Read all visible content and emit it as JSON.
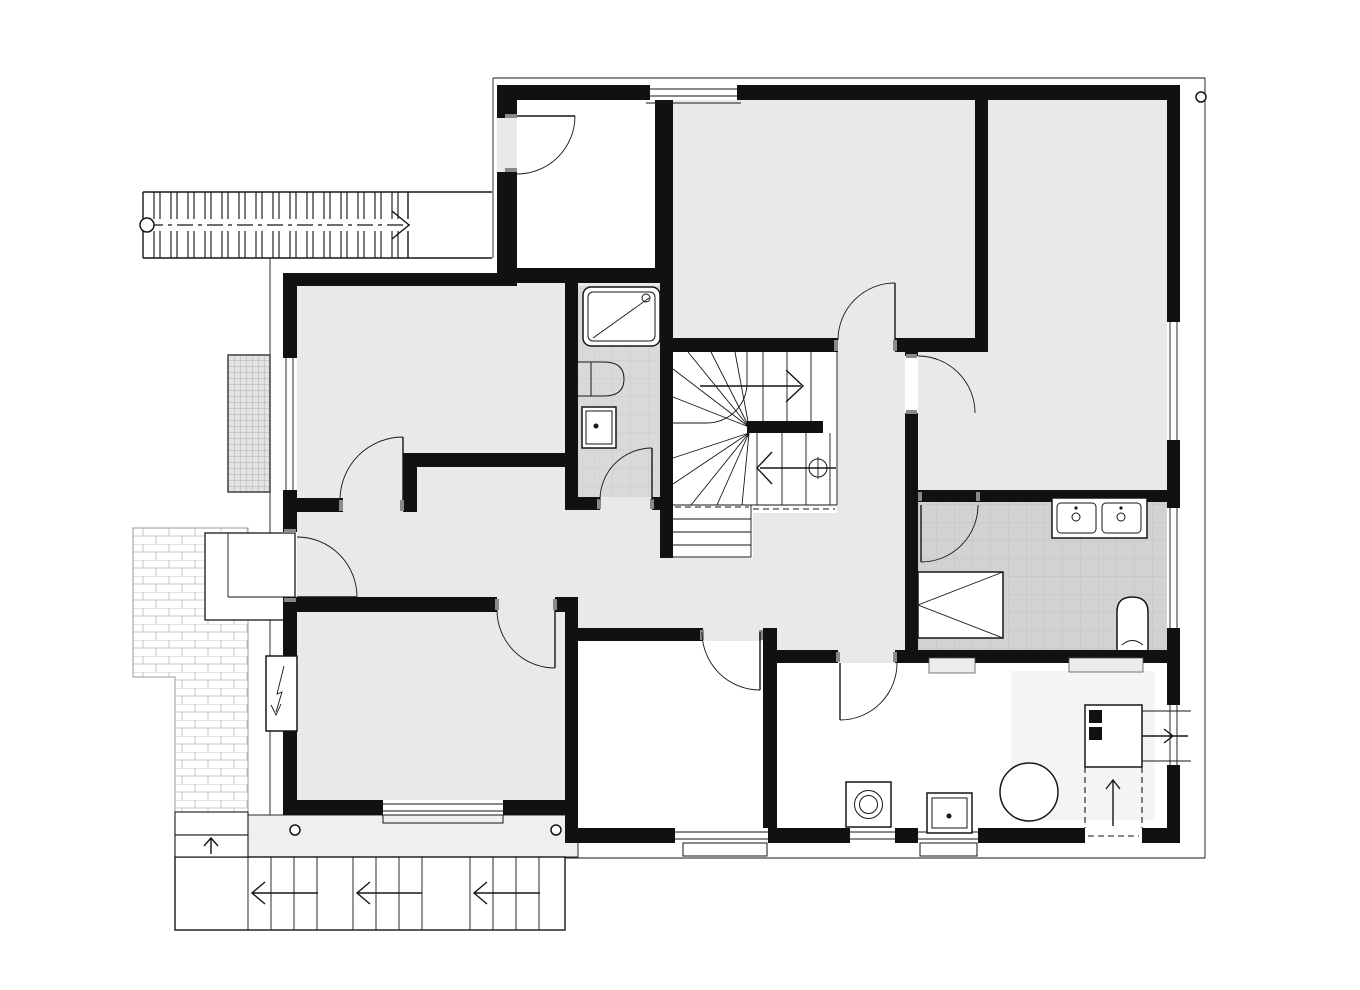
{
  "document": {
    "type": "architectural-floor-plan",
    "level": "basement-storey",
    "style": "black-and-white CAD line drawing, no text labels",
    "canvas_px": {
      "width": 1360,
      "height": 990
    }
  },
  "colors": {
    "background": "#ffffff",
    "wall": "#111111",
    "room_gray": "#e9e9e9",
    "bath_tile": "#d9d9d9",
    "kitchen_tile": "#d2d2d2",
    "terrace": "#efefef",
    "platform": "#f4f4f4",
    "niche": "#ececec",
    "drawing_line": "#161616",
    "brick_line": "#c8c8c8",
    "lightwell_fill": "#e3e3e3",
    "lightwell_line": "#9d9d9d"
  },
  "rooms": [
    {
      "name": "entry-vestibule-room",
      "floor": "white",
      "position": "top-left inside plan"
    },
    {
      "name": "top-center-room",
      "floor": "gray",
      "position": "top-center"
    },
    {
      "name": "top-right-room",
      "floor": "gray",
      "position": "top-right, L-shaped"
    },
    {
      "name": "left-upper-room",
      "floor": "gray",
      "position": "left"
    },
    {
      "name": "left-lower-room",
      "floor": "gray",
      "position": "bottom-left"
    },
    {
      "name": "hallway",
      "floor": "gray",
      "position": "central connecting corridor"
    },
    {
      "name": "bathroom",
      "floor": "tiled",
      "position": "center-left, shower + wc + basin"
    },
    {
      "name": "stairwell",
      "floor": "white",
      "position": "center winder stair"
    },
    {
      "name": "bottom-middle-room",
      "floor": "white",
      "position": "bottom-center"
    },
    {
      "name": "kitchen-laundry-room",
      "floor": "tiled",
      "position": "right, double sink"
    },
    {
      "name": "boiler-room",
      "floor": "white",
      "position": "bottom-right, appliances"
    }
  ],
  "fixtures": [
    "shower-tray",
    "toilet",
    "washbasin",
    "double-sink",
    "fold-down-table",
    "small-basin",
    "washing-machine",
    "laundry-tub",
    "boiler-tank",
    "heating-unit",
    "flue-shaft",
    "electric-meter-box"
  ],
  "stairs": {
    "exterior_top_stair": {
      "treads": 16,
      "direction_arrow": "right",
      "walkline": "dash-dot with start circle"
    },
    "interior_winder_stair": {
      "flights": 3,
      "up_arrow": "right",
      "down_arrow": "left",
      "newel_symbol": "circle-with-cross"
    },
    "exterior_bottom_stair": {
      "flights": 3,
      "treads_per_flight": 3,
      "direction_arrows": "left",
      "side_step_arrow": "up"
    }
  },
  "site_elements": [
    "brick-paved-path",
    "light-well",
    "entrance-stoop",
    "terrace-strip",
    "eaves-outline",
    "downspout-circles"
  ],
  "counts": {
    "doors": 10,
    "windows": 9,
    "downspouts": 3
  }
}
